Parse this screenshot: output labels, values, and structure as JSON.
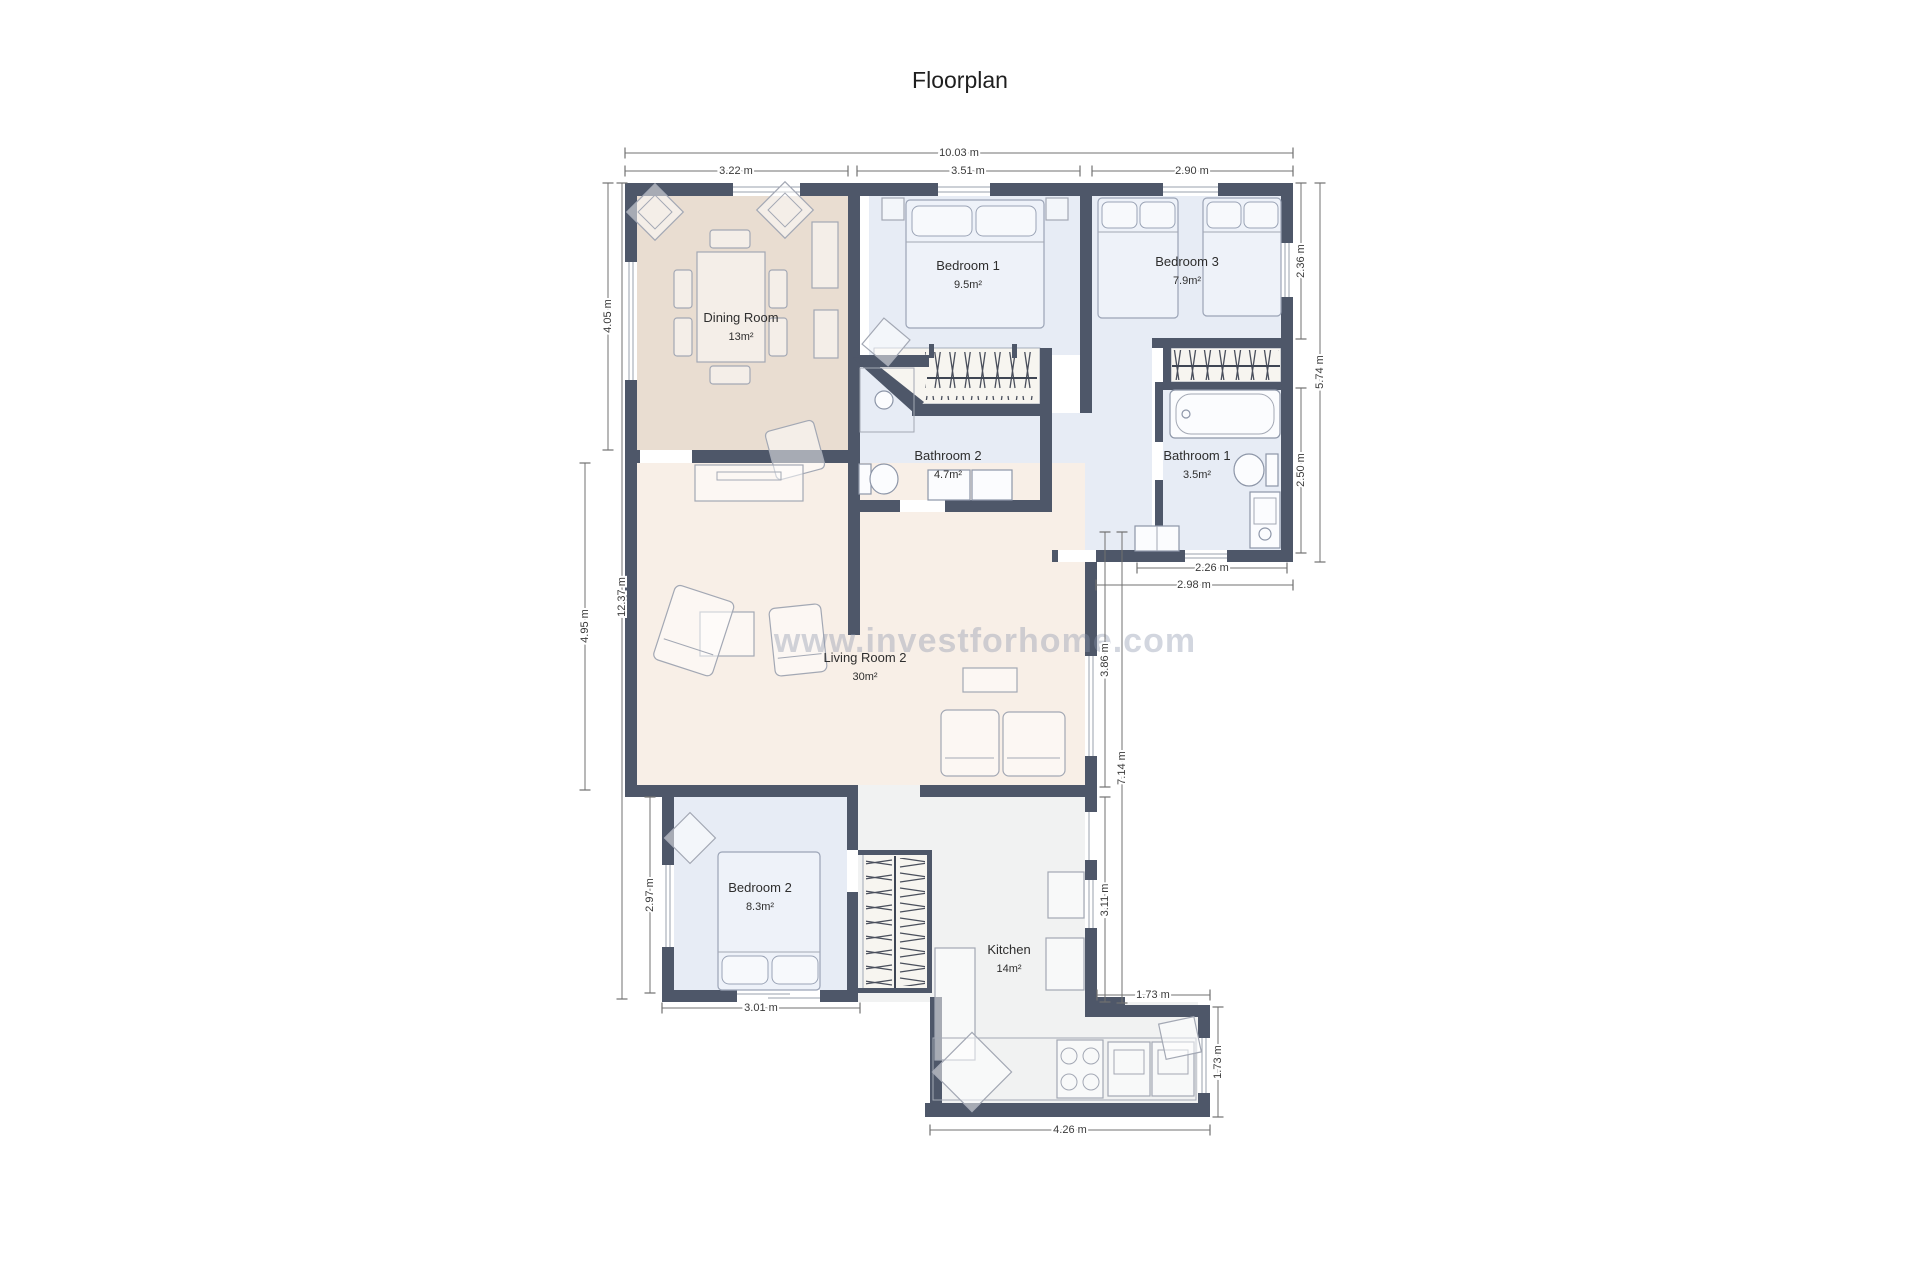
{
  "title": "Floorplan",
  "watermark": "www.investforhome.com",
  "rooms": {
    "dining": {
      "name": "Dining Room",
      "area": "13m²"
    },
    "bedroom1": {
      "name": "Bedroom 1",
      "area": "9.5m²"
    },
    "bedroom3": {
      "name": "Bedroom 3",
      "area": "7.9m²"
    },
    "bathroom2": {
      "name": "Bathroom 2",
      "area": "4.7m²"
    },
    "bathroom1": {
      "name": "Bathroom 1",
      "area": "3.5m²"
    },
    "living": {
      "name": "Living Room 2",
      "area": "30m²"
    },
    "bedroom2": {
      "name": "Bedroom 2",
      "area": "8.3m²"
    },
    "kitchen": {
      "name": "Kitchen",
      "area": "14m²"
    }
  },
  "dimensions": {
    "total_width": "10.03 m",
    "dining_width": "3.22 m",
    "bedroom1_width": "3.51 m",
    "bedroom3_width": "2.90 m",
    "dining_height": "4.05 m",
    "left_total_height": "12.37 m",
    "living_height": "4.95 m",
    "bedroom3_height": "2.36 m",
    "right_total_height": "5.74 m",
    "bathroom1_height": "2.50 m",
    "bathroom1_width": "2.26 m",
    "hall_bathroom_width": "2.98 m",
    "living_east": "3.86 m",
    "east_total": "7.14 m",
    "kitchen_east": "3.11 m",
    "bedroom2_height": "2.97 m",
    "bedroom2_width": "3.01 m",
    "step_width": "1.73 m",
    "step_height": "1.73 m",
    "kitchen_width": "4.26 m"
  },
  "colors": {
    "wall": "#4e5769",
    "dining_floor": "#e9ddd1",
    "blue_floor": "#e7ecf5",
    "cream_floor": "#f8efe7",
    "gray_floor": "#f1f2f2",
    "watermark": "#8a94ac"
  }
}
